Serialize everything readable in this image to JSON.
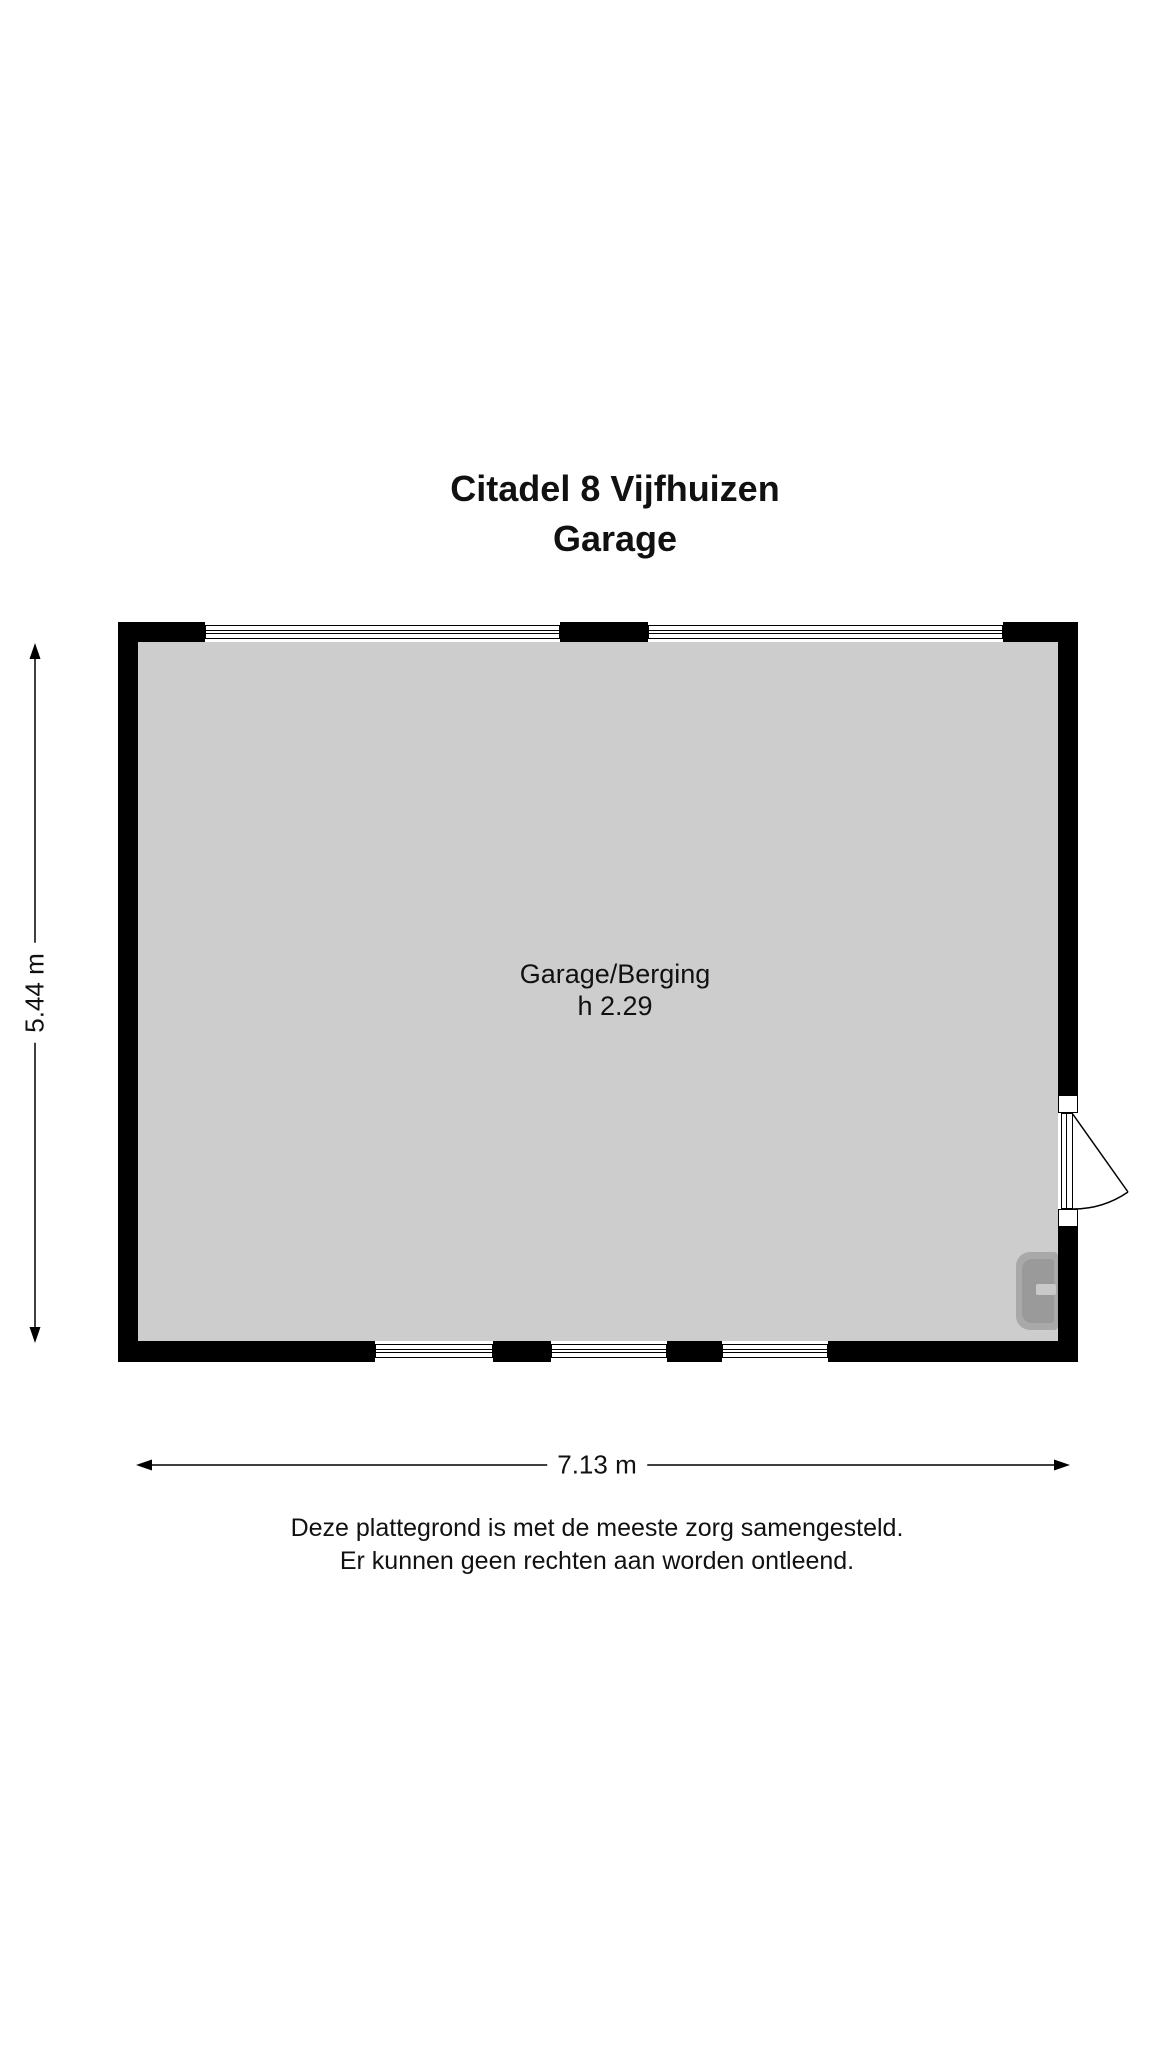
{
  "title": {
    "address": "Citadel 8 Vijfhuizen",
    "floor": "Garage"
  },
  "plan": {
    "room_label": "Garage/Berging",
    "room_height": "h 2.29",
    "width_dim": "7.13 m",
    "height_dim": "5.44 m"
  },
  "disclaimer": {
    "line1": "Deze plattegrond is met de meeste zorg samengesteld.",
    "line2": "Er kunnen geen rechten aan worden ontleend."
  },
  "colors": {
    "wall": "#000000",
    "floor": "#cdcdcd",
    "background": "#ffffff",
    "fixture": "#a9a9a9",
    "text": "#111111"
  }
}
